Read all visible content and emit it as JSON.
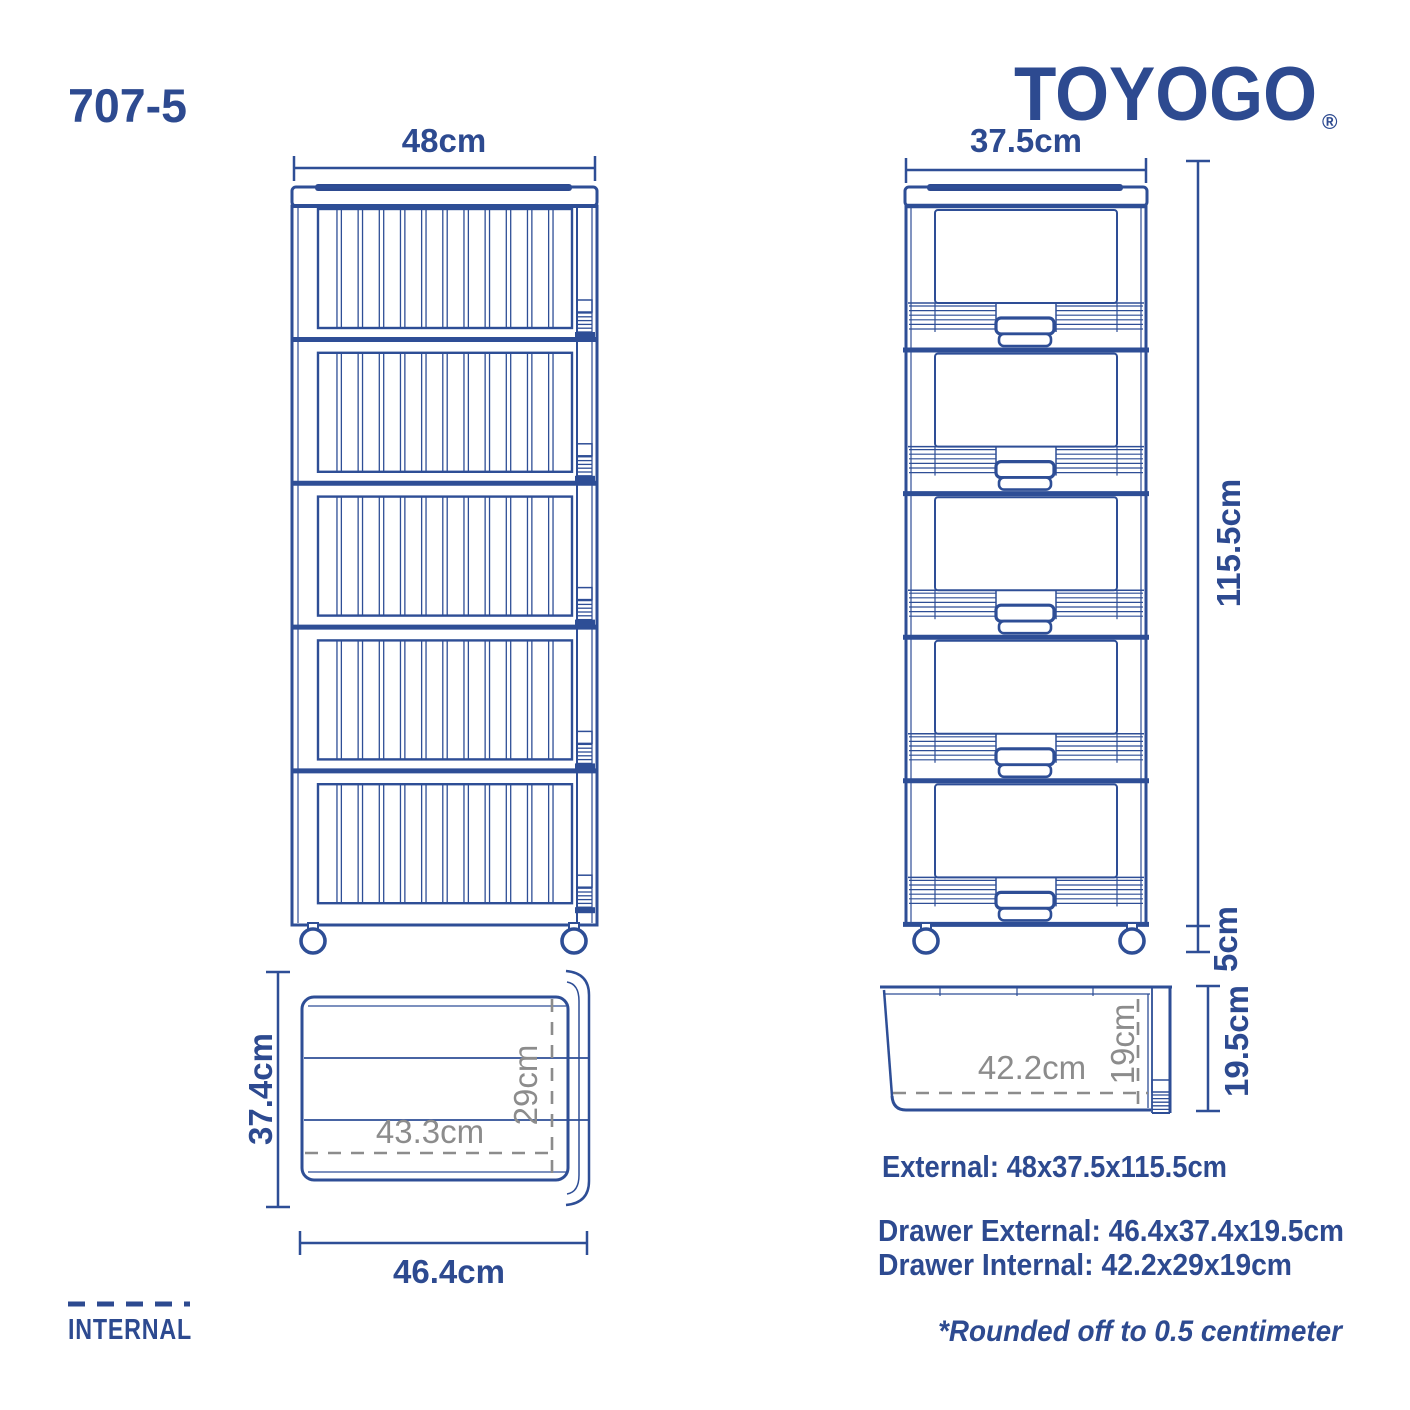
{
  "title": {
    "model": "707-5",
    "brand": "TOYOGO",
    "registered_mark": "®"
  },
  "colors": {
    "line_blue": "#2e4e96",
    "text_blue": "#2d4a90",
    "gray": "#8c8c8c",
    "background": "#ffffff"
  },
  "front_view": {
    "width": "48cm"
  },
  "side_view": {
    "depth": "37.5cm",
    "body_height": "115.5cm",
    "wheel_height": "5cm"
  },
  "drawer_top_view": {
    "external_depth": "37.4cm",
    "internal_length": "43.3cm",
    "internal_depth": "29cm",
    "external_width": "46.4cm"
  },
  "drawer_side_view": {
    "internal_length": "42.2cm",
    "internal_height": "19cm",
    "external_height": "19.5cm"
  },
  "specs": {
    "external": "External: 48x37.5x115.5cm",
    "drawer_external": "Drawer External: 46.4x37.4x19.5cm",
    "drawer_internal": "Drawer Internal: 42.2x29x19cm",
    "note": "*Rounded off to 0.5 centimeter"
  },
  "legend": {
    "label": "INTERNAL"
  }
}
